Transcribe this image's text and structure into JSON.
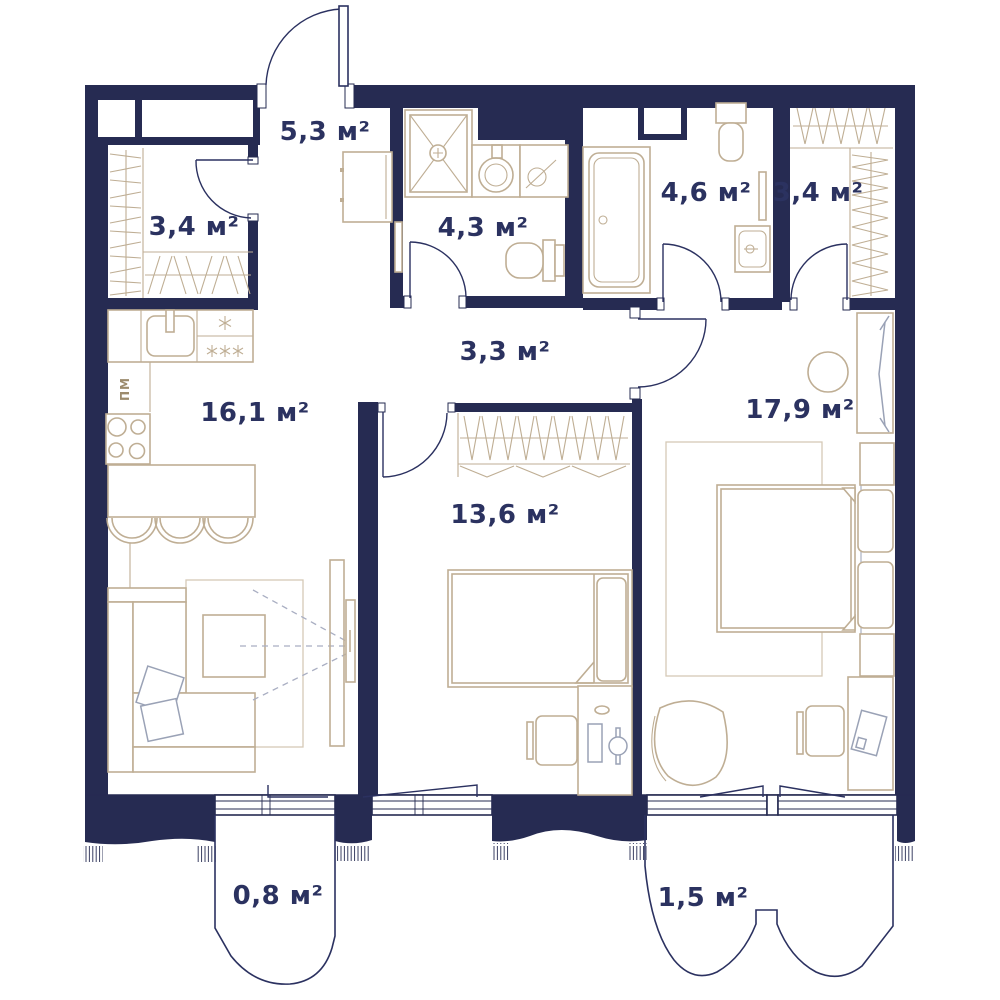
{
  "plan": {
    "unit": "м²",
    "rooms": [
      {
        "id": "entry-hall",
        "area": "5,3 м²"
      },
      {
        "id": "wardrobe-left",
        "area": "3,4 м²"
      },
      {
        "id": "bathroom-shower",
        "area": "4,3 м²"
      },
      {
        "id": "bathroom-tub",
        "area": "4,6 м²"
      },
      {
        "id": "wardrobe-right",
        "area": "3,4 м²"
      },
      {
        "id": "corridor",
        "area": "3,3 м²"
      },
      {
        "id": "kitchen-living",
        "area": "16,1 м²"
      },
      {
        "id": "bedroom",
        "area": "13,6 м²"
      },
      {
        "id": "bedroom-master",
        "area": "17,9 м²"
      },
      {
        "id": "balcony-small",
        "area": "0,8 м²"
      },
      {
        "id": "balcony-large",
        "area": "1,5 м²"
      }
    ],
    "labels": {
      "dishwasher": "ПМ"
    },
    "icons": {
      "fridge_single_star": "*",
      "fridge_triple_star": "***"
    },
    "colors": {
      "wall": "#262b52",
      "furniture": "#bfae94",
      "furniture_light": "#d5cab6",
      "metal": "#9aa2b6",
      "label": "#2b3260",
      "door": "#2b3160",
      "dishwasher_text": "#9c8b6d",
      "background": "#ffffff"
    }
  }
}
